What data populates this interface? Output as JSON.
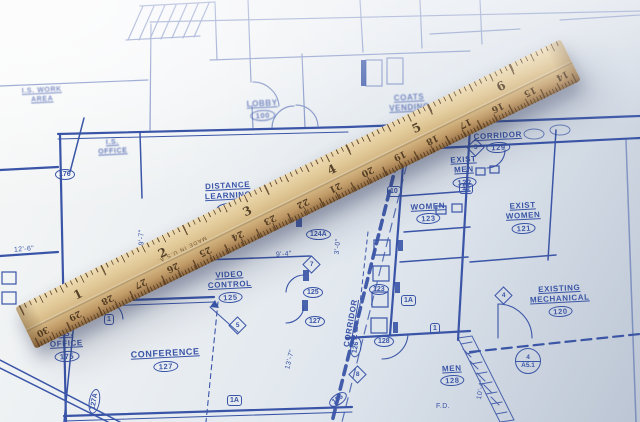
{
  "scene": {
    "subject": "Wooden ruler lying diagonally across an architectural blueprint floor plan"
  },
  "colors": {
    "ink": "#3a55a8",
    "ink_soft": "#7187c2",
    "paper": "#e9edf2",
    "paper_shade": "#c9d2de",
    "wood": "#dfc795",
    "wood_dark": "#8a6742",
    "tick": "#52381f"
  },
  "rooms": [
    {
      "lines": [
        "DISTANCE",
        "LEARNING"
      ],
      "number": "124"
    },
    {
      "lines": [
        "LOBBY"
      ],
      "number": "100"
    },
    {
      "lines": [
        "COATS",
        "VENDING"
      ],
      "number": ""
    },
    {
      "lines": [
        "CORRIDOR"
      ],
      "number": "129"
    },
    {
      "lines": [
        "EXIST",
        "MEN"
      ],
      "number": "122"
    },
    {
      "lines": [
        "WOMEN"
      ],
      "number": "123"
    },
    {
      "lines": [
        "EXIST",
        "WOMEN"
      ],
      "number": "121"
    },
    {
      "lines": [
        "VIDEO",
        "CONTROL"
      ],
      "number": "125"
    },
    {
      "lines": [
        "CONFERENCE"
      ],
      "number": "127"
    },
    {
      "lines": [
        "EXISTING",
        "MECHANICAL"
      ],
      "number": "120"
    },
    {
      "lines": [
        "MEN"
      ],
      "number": "128"
    },
    {
      "lines": [
        "CORRIDOR"
      ],
      "number": "126"
    },
    {
      "lines": [
        "I.S. WORK",
        "AREA"
      ],
      "number": ""
    },
    {
      "lines": [
        "I.S.",
        "OFFICE"
      ],
      "number": ""
    },
    {
      "lines": [
        "I.S.",
        "OFFICE"
      ],
      "number": "175"
    }
  ],
  "dimensions": [
    {
      "text": "12'-6\""
    },
    {
      "text": "19'-7\""
    },
    {
      "text": "9'-4\""
    },
    {
      "text": "13'-7\""
    },
    {
      "text": "3'-0\""
    },
    {
      "text": "10'-4\""
    },
    {
      "text": "F.D."
    }
  ],
  "tags": [
    {
      "shape": "oval",
      "text": "176"
    },
    {
      "shape": "oval",
      "text": "124A"
    },
    {
      "shape": "diamond",
      "text": "7"
    },
    {
      "shape": "oval",
      "text": "125"
    },
    {
      "shape": "oval",
      "text": "127"
    },
    {
      "shape": "oval",
      "text": "123"
    },
    {
      "shape": "hex",
      "text": "1A"
    },
    {
      "shape": "oval",
      "text": "128"
    },
    {
      "shape": "hex",
      "text": "1"
    },
    {
      "shape": "diamond",
      "text": "8"
    },
    {
      "shape": "oval",
      "text": "126"
    },
    {
      "shape": "hex",
      "text": "1A"
    },
    {
      "shape": "diamond",
      "text": "5"
    },
    {
      "shape": "hex",
      "text": "1"
    },
    {
      "shape": "oval",
      "text": "127A"
    },
    {
      "shape": "hex",
      "text": "10"
    },
    {
      "shape": "hex",
      "text": "10"
    },
    {
      "shape": "diamond",
      "text": "5"
    },
    {
      "shape": "diamond",
      "text": "4"
    },
    {
      "shape": "section",
      "top": "4",
      "bottom": "A5.1"
    }
  ],
  "ruler": {
    "inch_numbers": [
      "1",
      "2",
      "3",
      "4",
      "5",
      "6"
    ],
    "cm_numbers": [
      "30",
      "29",
      "28",
      "27",
      "26",
      "25",
      "24",
      "23",
      "22",
      "21",
      "20",
      "19",
      "18",
      "17",
      "16",
      "15",
      "14"
    ],
    "stamp": "MADE IN U.S.A."
  }
}
